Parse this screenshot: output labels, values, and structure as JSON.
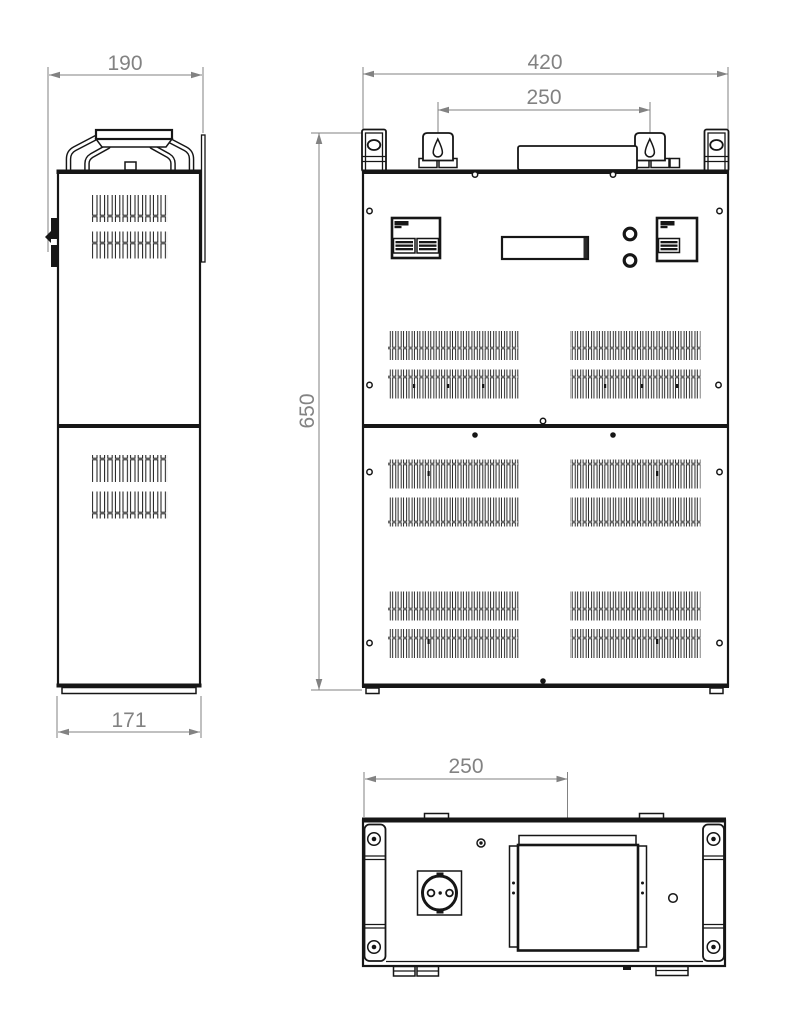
{
  "drawing": {
    "background_color": "#ffffff",
    "line_color": "#161616",
    "dimension_color": "#828282",
    "views": {
      "side": {
        "dims": {
          "top_width": "190",
          "bottom_width": "171"
        }
      },
      "front": {
        "dims": {
          "width": "420",
          "mount_spacing": "250",
          "height": "650"
        }
      },
      "bottom": {
        "dims": {
          "panel_offset": "250"
        }
      }
    }
  }
}
